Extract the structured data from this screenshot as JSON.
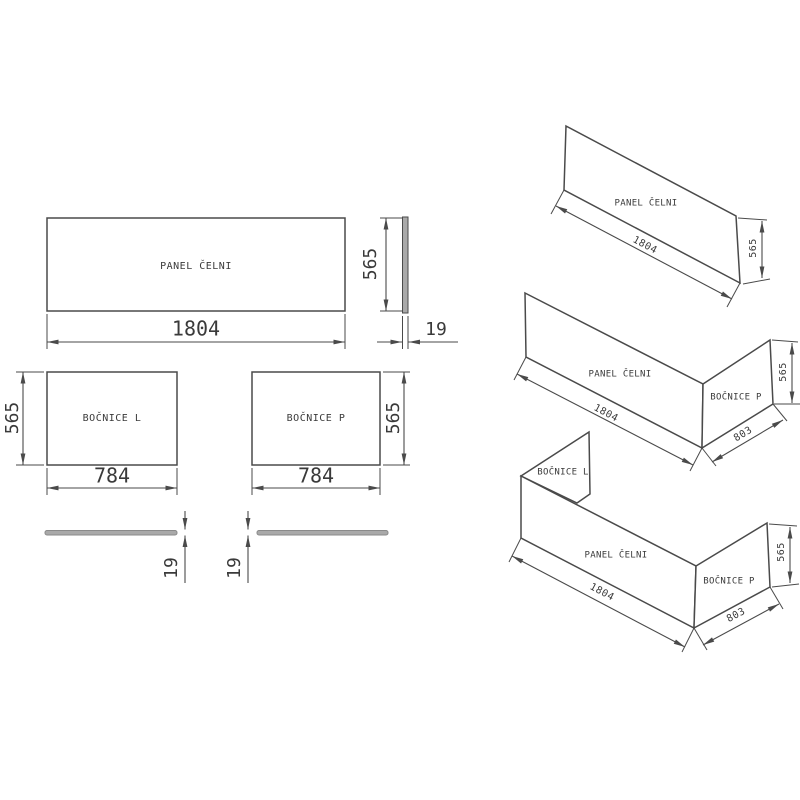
{
  "drawing": {
    "labels": {
      "front_panel": "PANEL ČELNI",
      "side_left": "BOČNICE L",
      "side_right": "BOČNICE P"
    },
    "dims": {
      "front_panel_length": "1804",
      "panel_height": "565",
      "side_panel_length": "784",
      "panel_thickness": "19",
      "side_panel_depth": "803"
    },
    "colors": {
      "line": "#4a4a4a",
      "text": "#3a3a3a",
      "edge_fill": "#a9a9a9",
      "panel_fill": "#ffffff",
      "background": "#ffffff"
    }
  }
}
